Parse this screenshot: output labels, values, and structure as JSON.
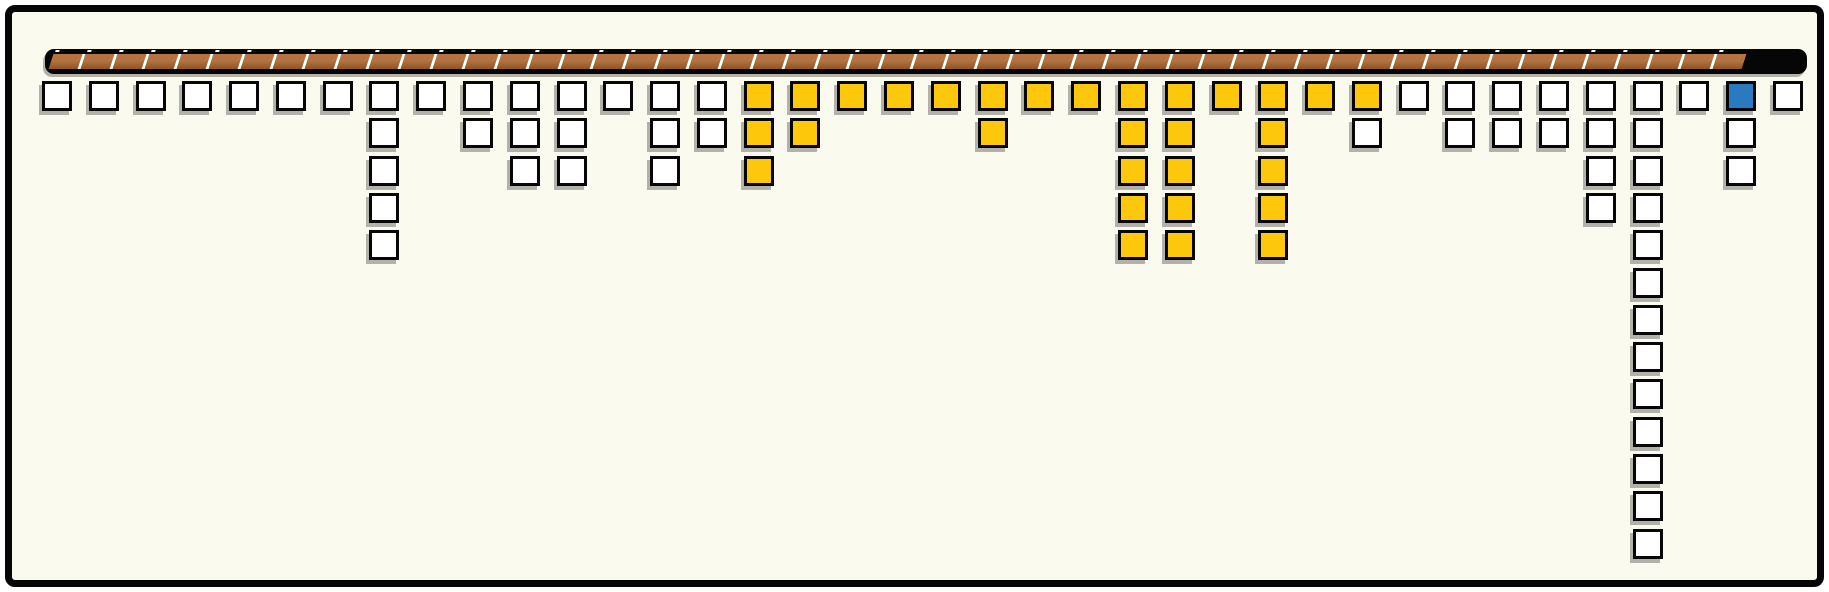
{
  "palette": {
    "paper": "#FBFAEE",
    "ink": "#060606",
    "white": "#FFFFFF",
    "yellow": "#FDC70C",
    "blue": "#2A7ABF",
    "shadow": "rgba(70,70,70,0.40)",
    "track_light": "#B5743F",
    "track_dark": "#8E5326",
    "track_sep": "#FFFFFF",
    "track_dot": "#FFFFFF"
  },
  "track_bar": {
    "segment_count": 53
  },
  "grid": {
    "column_count": 38,
    "columns": [
      [
        "white"
      ],
      [
        "white"
      ],
      [
        "white"
      ],
      [
        "white"
      ],
      [
        "white"
      ],
      [
        "white"
      ],
      [
        "white"
      ],
      [
        "white",
        "white",
        "white",
        "white",
        "white"
      ],
      [
        "white"
      ],
      [
        "white",
        "white"
      ],
      [
        "white",
        "white",
        "white"
      ],
      [
        "white",
        "white",
        "white"
      ],
      [
        "white"
      ],
      [
        "white",
        "white",
        "white"
      ],
      [
        "white",
        "white"
      ],
      [
        "yellow",
        "yellow",
        "yellow"
      ],
      [
        "yellow",
        "yellow"
      ],
      [
        "yellow"
      ],
      [
        "yellow"
      ],
      [
        "yellow"
      ],
      [
        "yellow",
        "yellow"
      ],
      [
        "yellow"
      ],
      [
        "yellow"
      ],
      [
        "yellow",
        "yellow",
        "yellow",
        "yellow",
        "yellow"
      ],
      [
        "yellow",
        "yellow",
        "yellow",
        "yellow",
        "yellow"
      ],
      [
        "yellow"
      ],
      [
        "yellow",
        "yellow",
        "yellow",
        "yellow",
        "yellow"
      ],
      [
        "yellow"
      ],
      [
        "yellow",
        "white"
      ],
      [
        "white"
      ],
      [
        "white",
        "white"
      ],
      [
        "white",
        "white"
      ],
      [
        "white",
        "white"
      ],
      [
        "white",
        "white",
        "white",
        "white"
      ],
      [
        "white",
        "white",
        "white",
        "white",
        "white",
        "white",
        "white",
        "white",
        "white",
        "white",
        "white",
        "white",
        "white"
      ],
      [
        "white"
      ],
      [
        "blue",
        "white",
        "white"
      ],
      [
        "white"
      ]
    ]
  }
}
